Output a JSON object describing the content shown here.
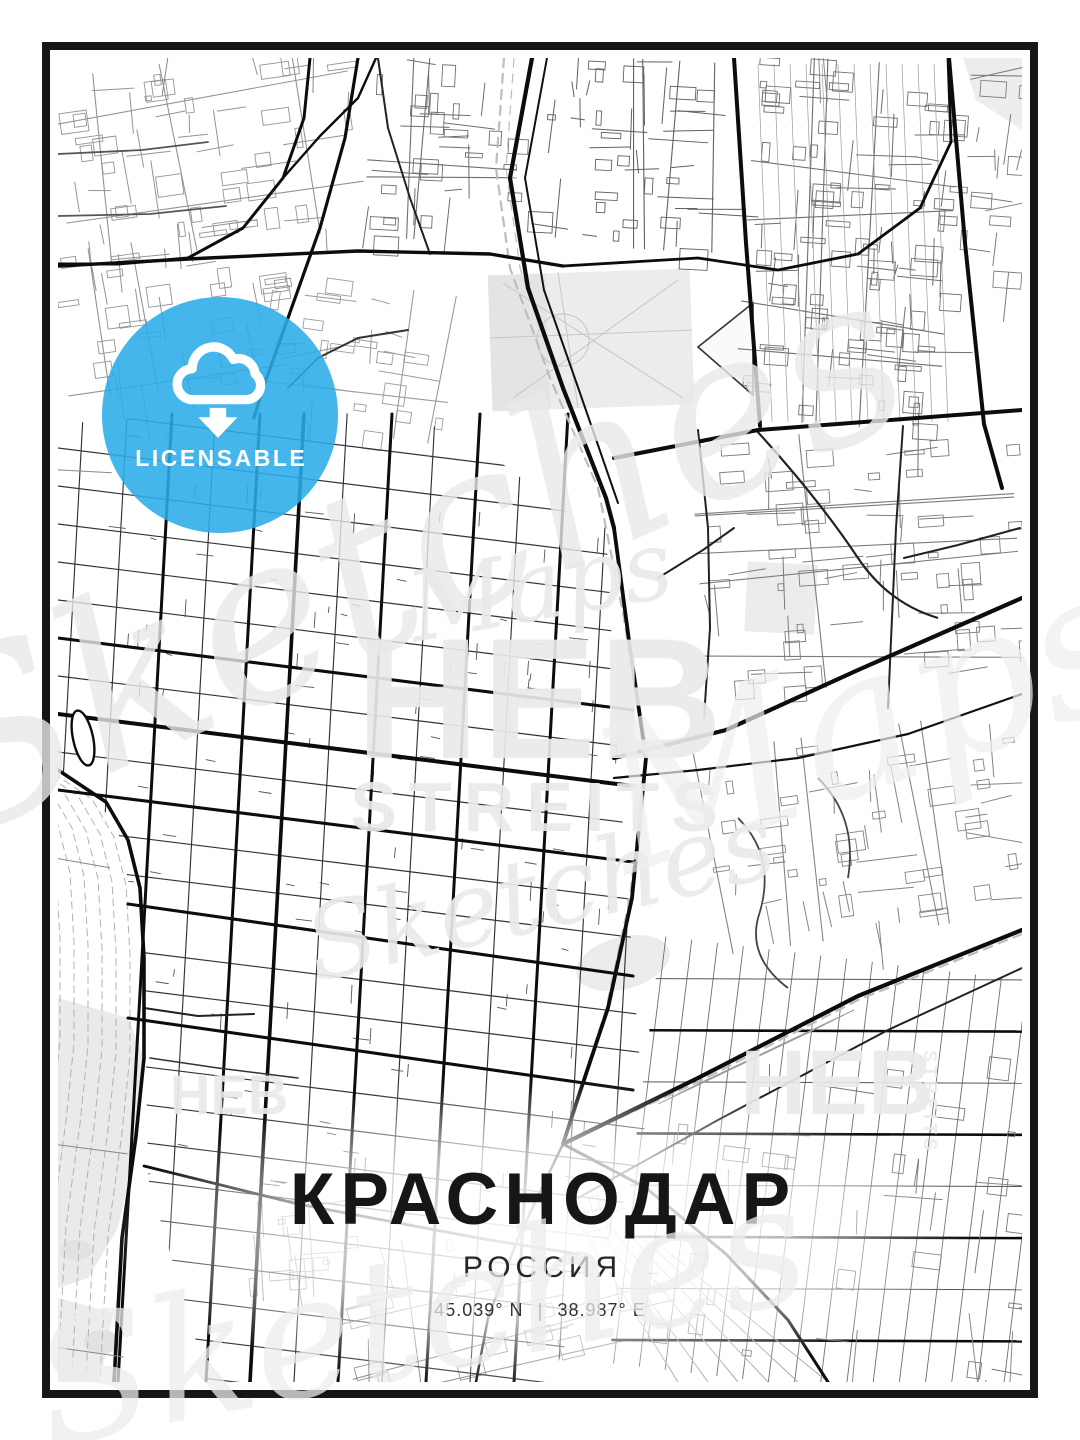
{
  "poster": {
    "title": "КРАСНОДАР",
    "subtitle": "РОССИЯ",
    "latitude": "45.039° N",
    "longitude": "38.987° E",
    "separator": "|"
  },
  "badge": {
    "label": "LICENSABLE",
    "color": "#2BACE8",
    "text_color": "#FFFFFF",
    "icon": "cloud-download-icon"
  },
  "watermark": {
    "script_top": "Maps",
    "block_top": "HEB",
    "block_bottom": "STREITS",
    "script_bottom": "Sketches",
    "corner_block": "HEB",
    "corner_side": "STREITS"
  },
  "map_style": {
    "background": "#FFFFFF",
    "ink": "#0C0C0C",
    "minor": "#333333",
    "suburb": "#949494",
    "faint": "#C6C6C6",
    "rail": "#BDBDBD",
    "park": "#ECECEC",
    "frame": "#161616"
  }
}
